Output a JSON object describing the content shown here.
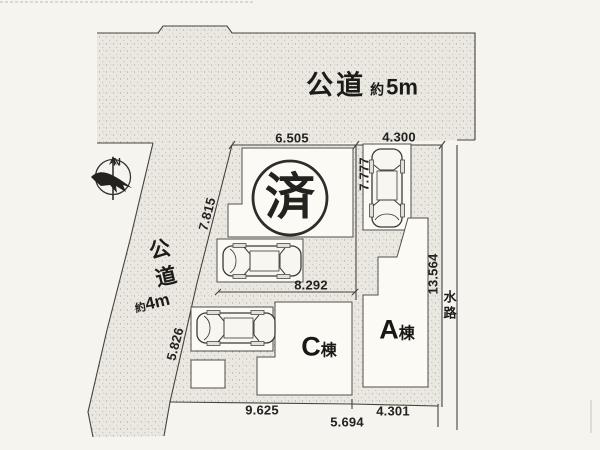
{
  "plan": {
    "sold_badge": "済",
    "compass_north": "N",
    "roads": {
      "top": {
        "name": "公道",
        "width_prefix": "約",
        "width_value": "5m"
      },
      "left": {
        "name": "公道",
        "width_prefix": "約",
        "width_value": "4m"
      }
    },
    "waterway_label": "水路",
    "buildings": {
      "a": {
        "letter": "A",
        "suffix": "棟"
      },
      "c": {
        "letter": "C",
        "suffix": "棟"
      }
    },
    "dimensions": {
      "top_left": "6.505",
      "top_right": "4.300",
      "inner_vertical": "7.777",
      "west_upper": "7.815",
      "west_lower": "5.826",
      "inner_width": "8.292",
      "east_side": "13.564",
      "bottom_left": "9.625",
      "bottom_center": "5.694",
      "bottom_right": "4.301"
    }
  }
}
